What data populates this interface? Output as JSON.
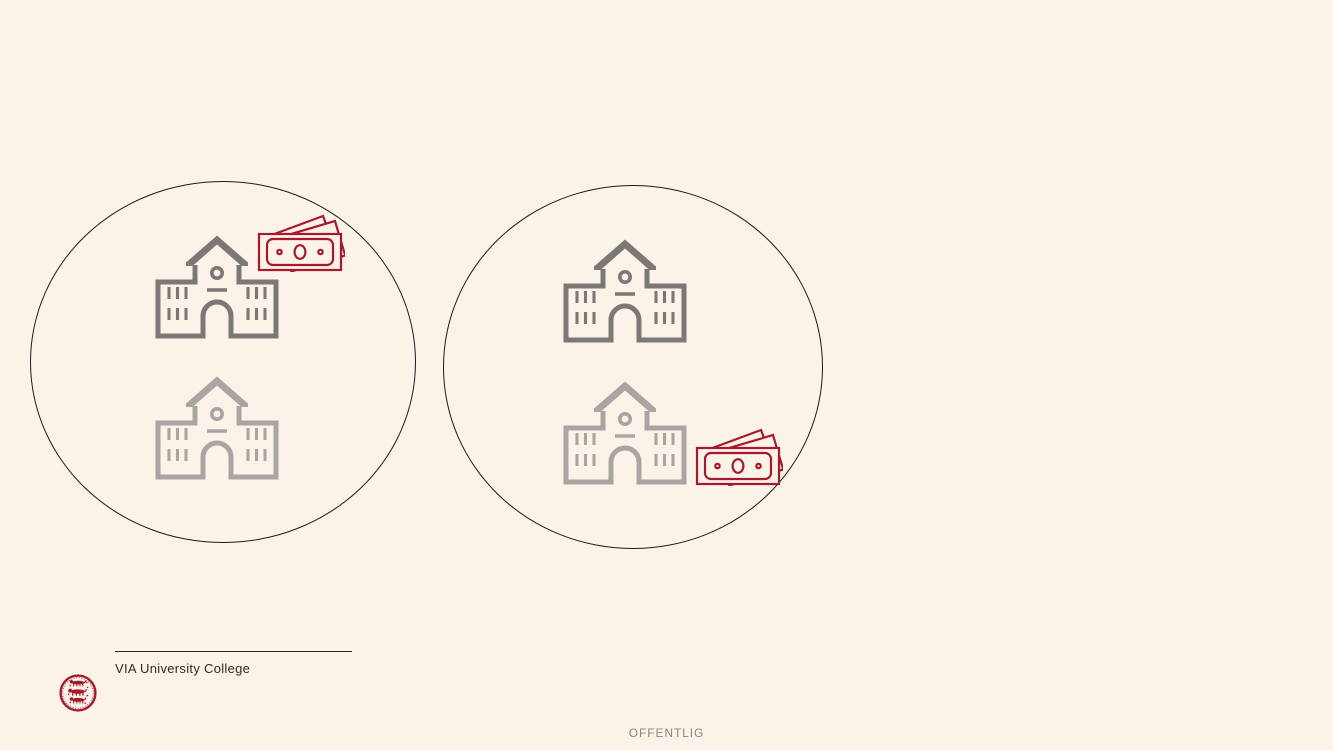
{
  "slide": {
    "background_color": "#FBF2E8",
    "classification_footer": "OFFENTLIG"
  },
  "branding": {
    "org_name": "VIA University College",
    "seal_icon": "danish-three-lions-seal",
    "brand_red": "#A6192E"
  },
  "colors": {
    "background": "#FBF2E8",
    "circle_stroke": "#1C1C1C",
    "building_dark": "#7B7876",
    "building_light": "#A9A5A2",
    "money_red": "#A6192E",
    "divider": "#2B2926",
    "org_text": "#2E2C29",
    "classification_text": "#8A8983"
  },
  "diagram": {
    "description": "Two encircled groups of school buildings; in the left group the top (dark) school has banknotes at its top right, in the right group the bottom (light) school has banknotes at its bottom right",
    "groups": [
      {
        "id": "left-circle",
        "buildings": [
          {
            "icon": "school-building-icon",
            "tone": "dark",
            "money_icon": "banknotes-top-right"
          },
          {
            "icon": "school-building-icon",
            "tone": "light",
            "money_icon": null
          }
        ]
      },
      {
        "id": "right-circle",
        "buildings": [
          {
            "icon": "school-building-icon",
            "tone": "dark",
            "money_icon": null
          },
          {
            "icon": "school-building-icon",
            "tone": "light",
            "money_icon": "banknotes-bottom-right"
          }
        ]
      }
    ]
  }
}
